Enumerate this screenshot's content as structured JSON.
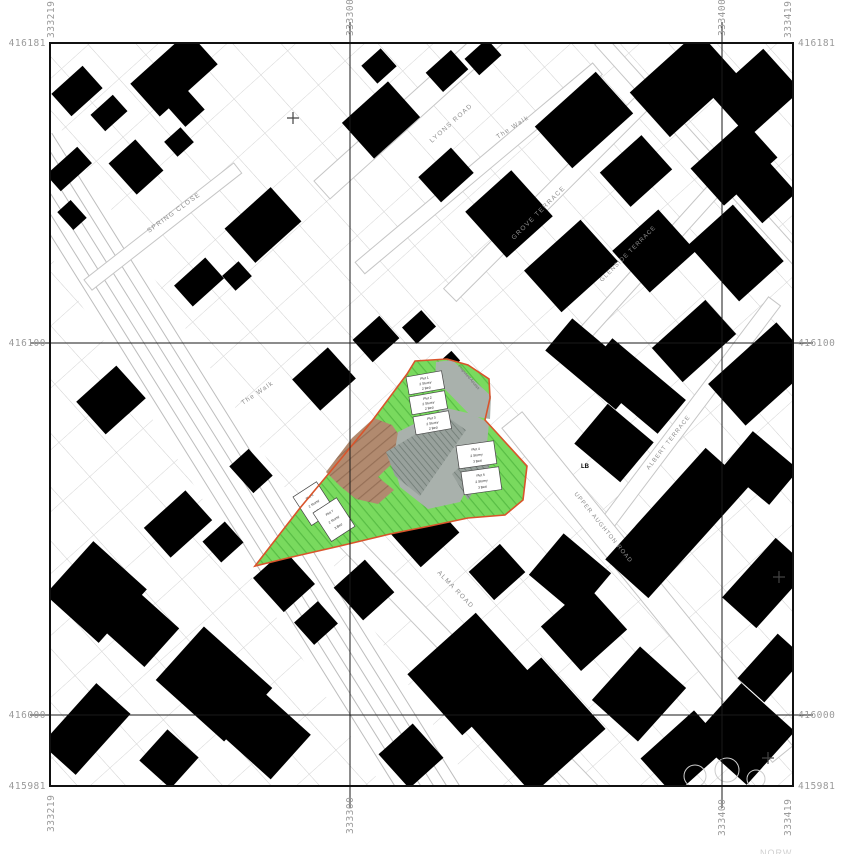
{
  "grid": {
    "e219": "333219",
    "e300": "333300",
    "e400": "333400",
    "e419": "333419",
    "n181": "416181",
    "n100": "416100",
    "n000": "416000",
    "n981": "415981"
  },
  "streets": {
    "lyons": "LYONS ROAD",
    "walk_top": "The Walk",
    "grove": "GROVE TERRACE",
    "glenside": "GLENSIDE TERRACE",
    "spring": "SPRING CLOSE",
    "walk_left": "The Walk",
    "alma": "ALMA ROAD",
    "upper_aughton": "UPPER AUGHTON ROAD",
    "albert": "ALBERT TERRACE"
  },
  "site": {
    "access_label": "Proposed Access",
    "lb": "LB",
    "plots": [
      {
        "lines": [
          "Plot 1",
          "2 Storey",
          "2 Bed"
        ]
      },
      {
        "lines": [
          "Plot 2",
          "2 Storey",
          "2 Bed"
        ]
      },
      {
        "lines": [
          "Plot 3",
          "2 Storey",
          "2 Bed"
        ]
      },
      {
        "lines": [
          "Plot 4",
          "2 Storey",
          "3 Bed"
        ]
      },
      {
        "lines": [
          "Plot 5",
          "2 Storey",
          "3 Bed"
        ]
      },
      {
        "lines": [
          "Plot 6",
          "2 Storey",
          "3 Bed"
        ]
      },
      {
        "lines": [
          "Plot 7",
          "2 Storey",
          "3 Bed"
        ]
      }
    ],
    "colors": {
      "green": "#79da5e",
      "green_stripe": "#58bd45",
      "brown": "#b18a6f",
      "brown_stripe": "#967057",
      "grey": "#a9b1ac",
      "grey_hatch": "#6f7a74",
      "boundary": "#d9542b"
    }
  },
  "misc": {
    "faint_text": "NORW"
  }
}
